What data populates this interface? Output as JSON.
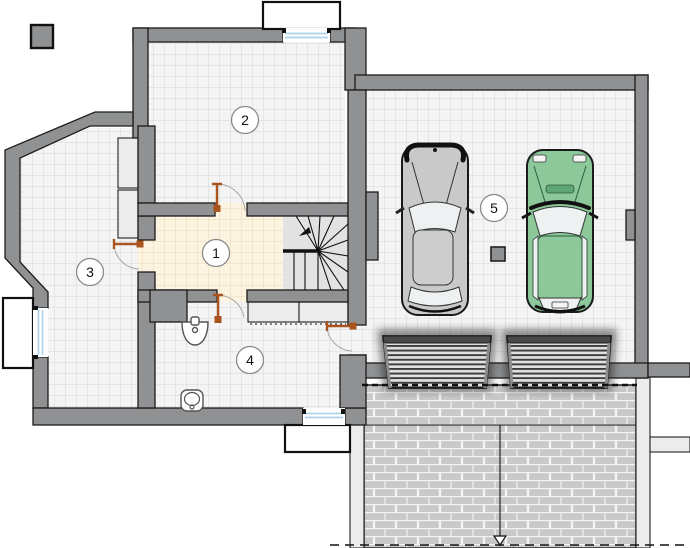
{
  "plan": {
    "figure": "floor-plan",
    "room_labels": [
      {
        "id": "room-1",
        "label": "1"
      },
      {
        "id": "room-2",
        "label": "2"
      },
      {
        "id": "room-3",
        "label": "3"
      },
      {
        "id": "room-4",
        "label": "4"
      },
      {
        "id": "room-5",
        "label": "5"
      }
    ],
    "colors": {
      "wall": "#8f9193",
      "wall_outline": "#1c1c1c",
      "tile_floor": "#f4f4f4",
      "tile_grid": "#d3d7d9",
      "hall_floor": "#fcf3e1",
      "hall_grid": "#ecdab8",
      "stairs_floor": "#e2e2e2",
      "door_leaf": "#a9541e",
      "door_arc": "#a8a8a8",
      "window_glass": "#aed2e8",
      "concrete_light": "#ececec",
      "brick": "#c8c8c8",
      "brick_joint": "#f2f2f2",
      "garage_door_slat_dark": "#3c3c3c",
      "garage_door_slat_light": "#e0e0e0",
      "car_gray": "#c9c9c9",
      "car_gray_roof": "#cdcdcd",
      "car_green": "#8cc89a",
      "car_glass": "#eef1f1",
      "label_ring": "#8a8a8a"
    },
    "icons": [
      "car-top-view-gray-icon",
      "car-top-view-green-icon",
      "staircase-icon",
      "stairs-direction-arrow-icon",
      "sink-icon",
      "toilet-icon",
      "door-swing-icon",
      "window-icon",
      "window-well-icon",
      "garage-sectional-door-icon",
      "column-icon",
      "drain-arrow-icon"
    ]
  }
}
